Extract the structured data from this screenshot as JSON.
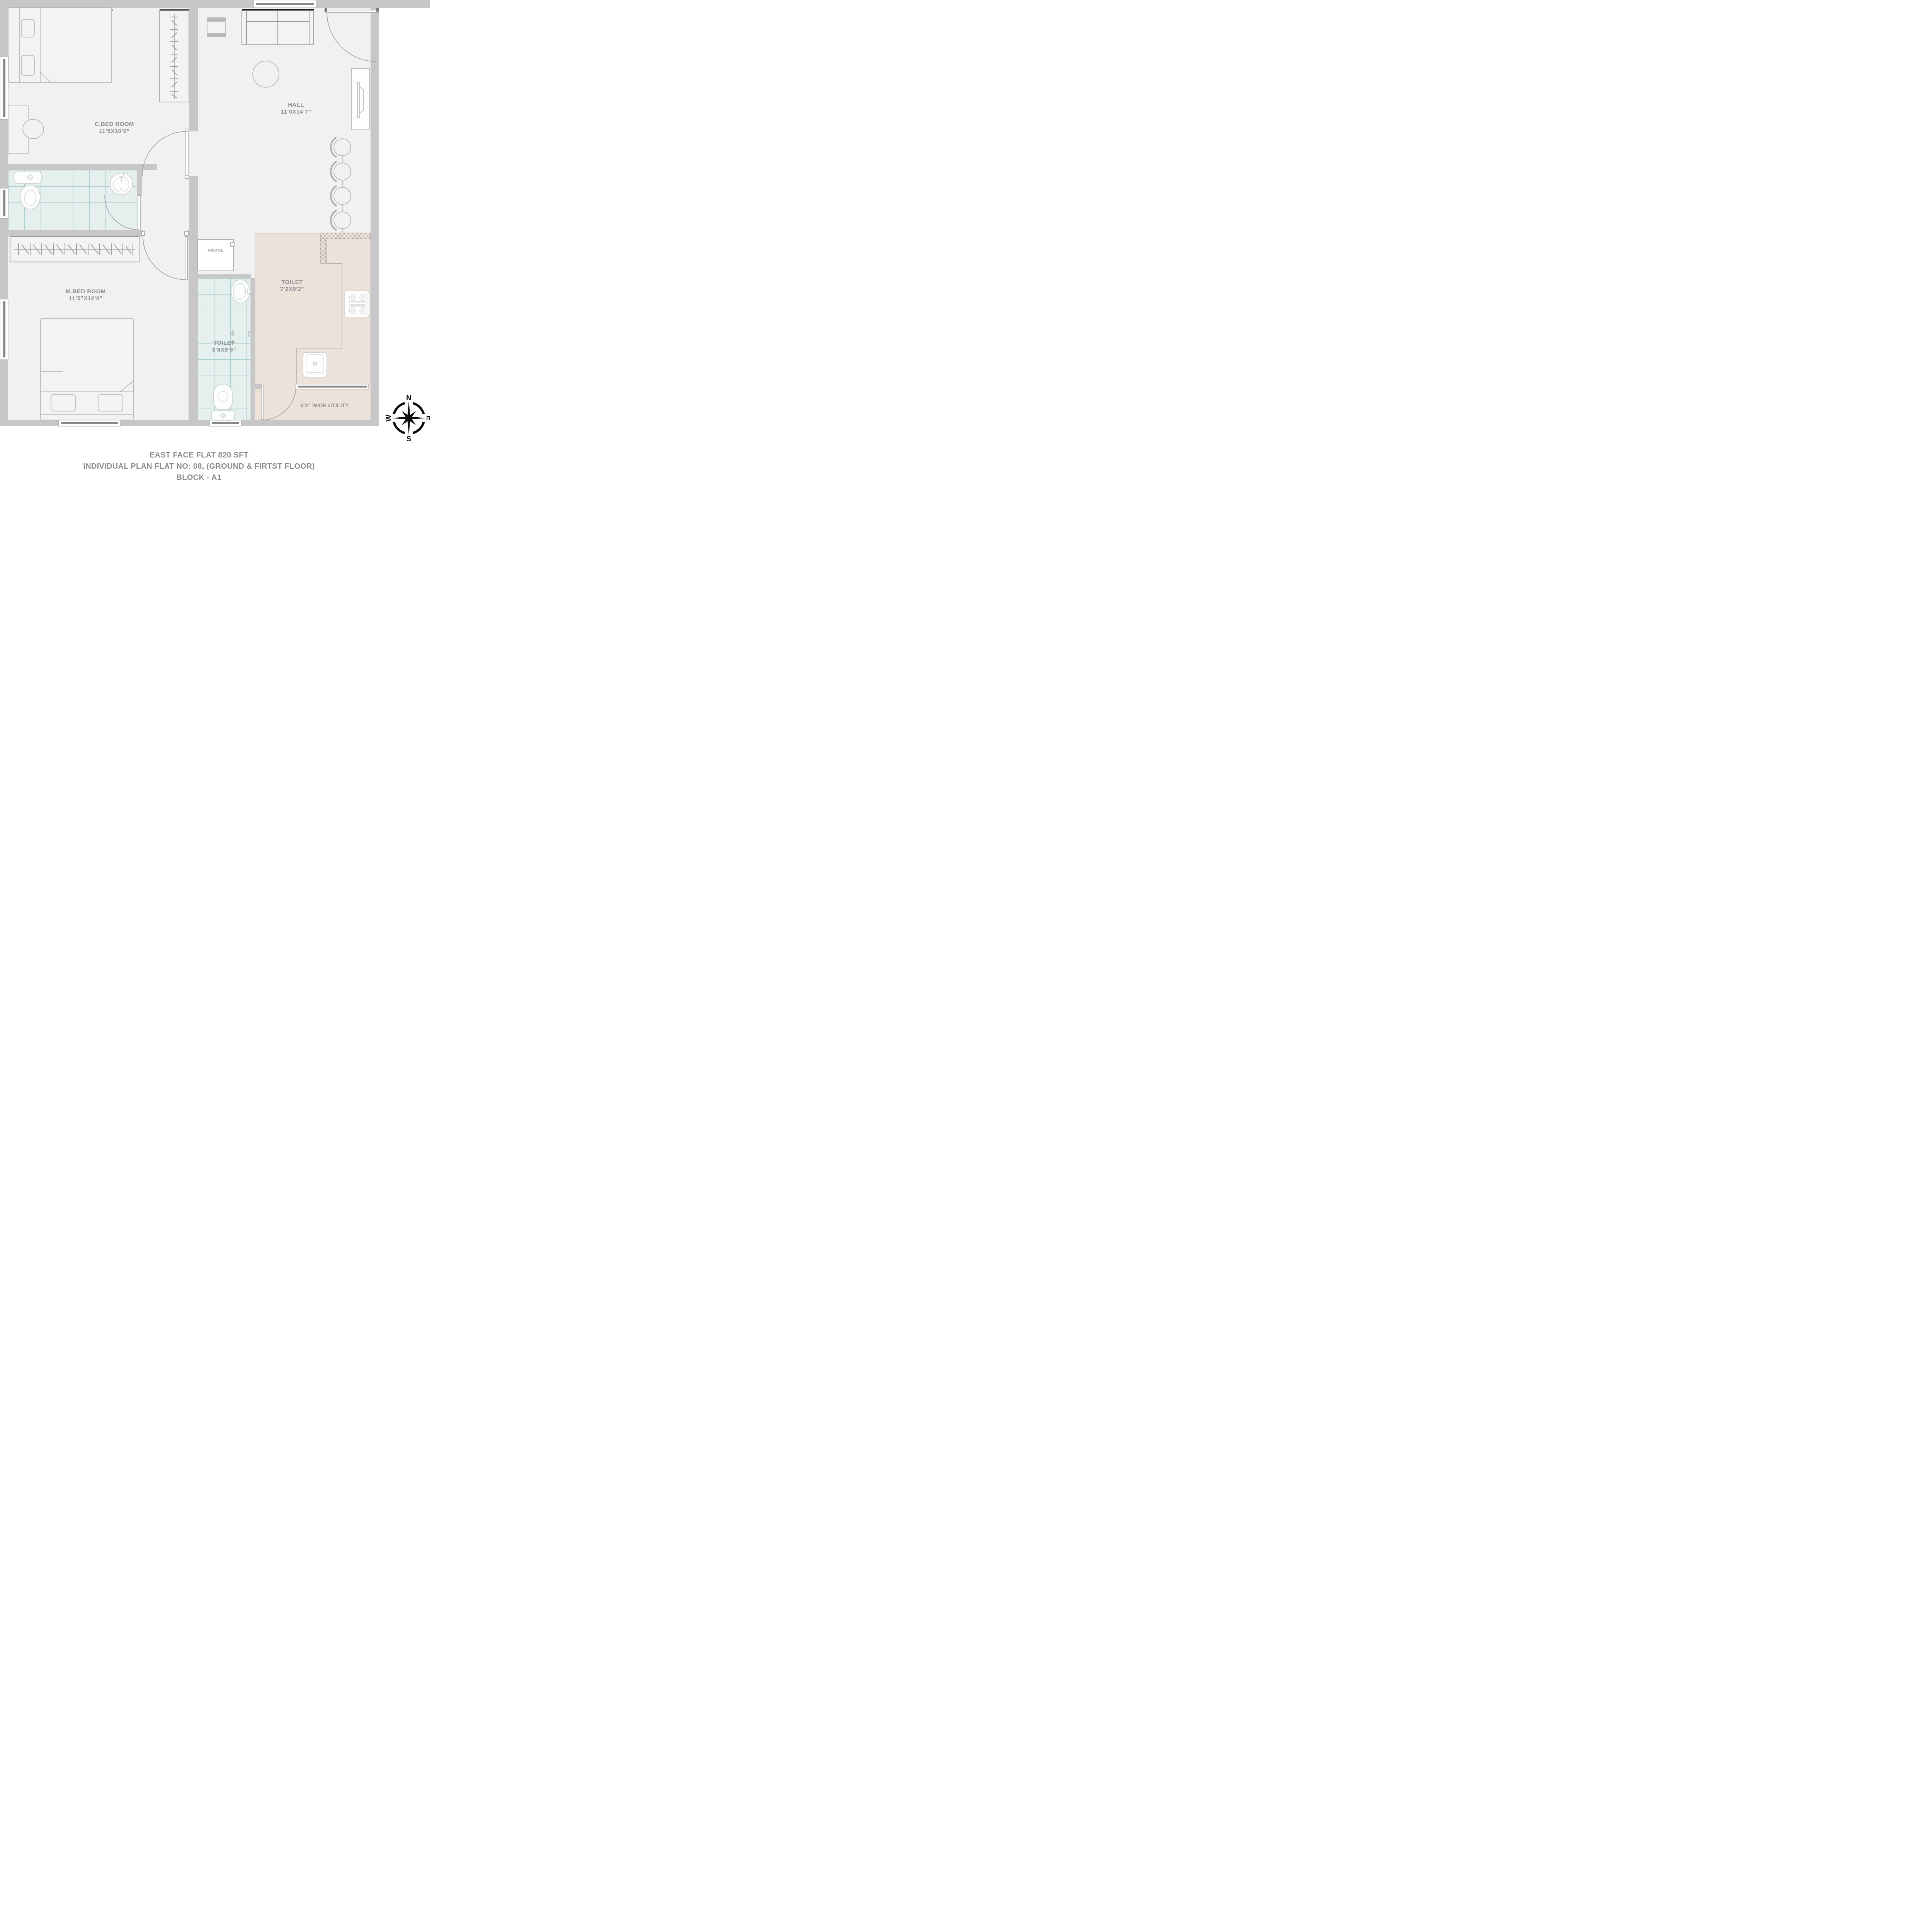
{
  "title_block": {
    "line1": "EAST FACE FLAT 820 SFT",
    "line2": "INDIVIDUAL PLAN FLAT NO: 08, (GROUND & FIRTST FLOOR)",
    "line3": "BLOCK - A1"
  },
  "rooms": [
    {
      "id": "cbed",
      "name": "C.BED ROOM",
      "dims": "11’5X10’0”"
    },
    {
      "id": "hall",
      "name": "HALL",
      "dims": "11’0X14’7”"
    },
    {
      "id": "mbed",
      "name": "M.BED ROOM",
      "dims": "11’5”X12’0”"
    },
    {
      "id": "toilet_big",
      "name": "TOILET",
      "dims": "7’2X9’2”"
    },
    {
      "id": "toilet_small",
      "name": "TOILET",
      "dims": "3’6X9’5”"
    },
    {
      "id": "utility",
      "name": "3’3” WIDE UTILITY"
    },
    {
      "id": "fridge",
      "name": "FRIDGE"
    }
  ],
  "compass": {
    "north": "N",
    "east": "E",
    "south": "S",
    "west": "W"
  },
  "colors": {
    "wall": "#c7c7c9",
    "floor": "#f1f1f2",
    "tile_bg": "#e4efee",
    "tile_line": "#a6cdc9",
    "kitchen_floor": "#ede2da",
    "label_text": "#8b8e92",
    "caption_text": "#8a8d90",
    "lintel_black": "#1c1c1e"
  }
}
